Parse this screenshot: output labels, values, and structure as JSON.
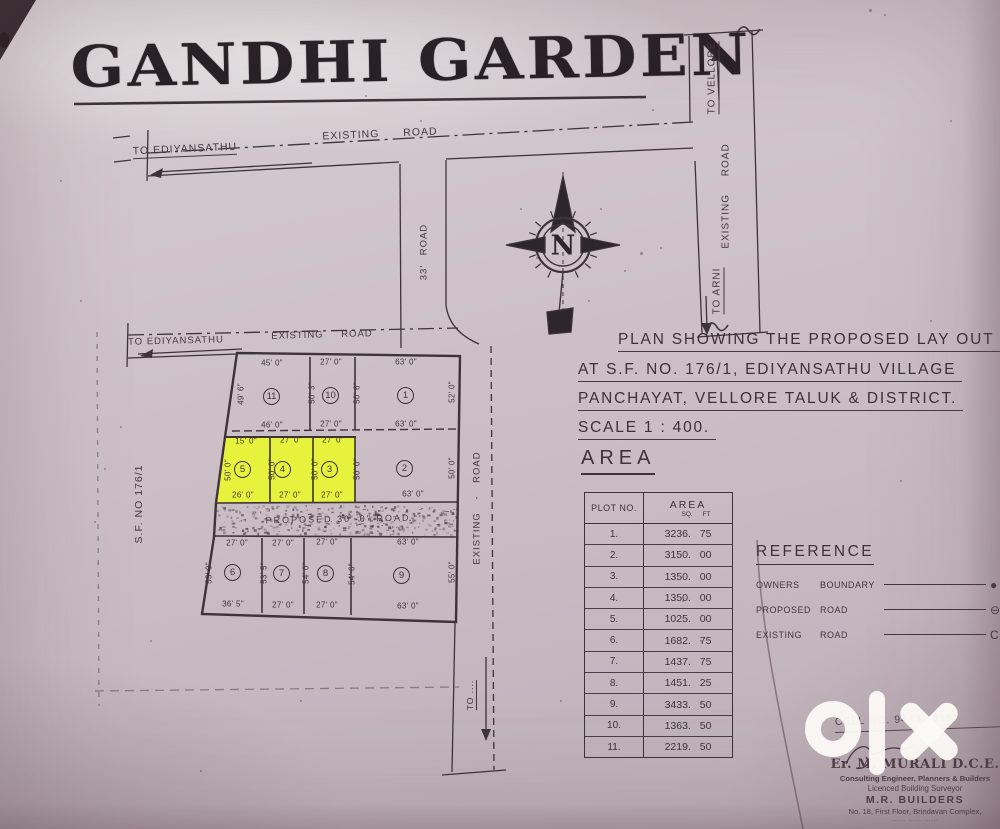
{
  "title": "GANDHI GARDEN",
  "watermark": "olx",
  "ink_color": "#3d3338",
  "highlight_color": "#e7f23d",
  "compass_label": "N",
  "top_road": {
    "destination": "TO EDIYANSATHU",
    "name": "EXISTING ROAD"
  },
  "highway": {
    "up": "TO VELLORE",
    "name": "EXISTING ROAD",
    "down": "TO ARNI"
  },
  "connector_road_label": "33' ROAD",
  "east_road": {
    "name": "EXISTING - ROAD",
    "down": "TO ...."
  },
  "layout_road": {
    "destination": "TO EDIYANSATHU",
    "name": "EXISTING ROAD"
  },
  "internal_road_label": "PROPOSED 30'-0\" ROAD",
  "survey_no_label": "S.F. NO 176/1",
  "plan_note": {
    "lines": [
      "PLAN SHOWING THE PROPOSED LAY OUT",
      "AT S.F. NO. 176/1,  EDIYANSATHU   VILLAGE",
      "PANCHAYAT,  VELLORE  TALUK  &  DISTRICT.",
      "SCALE  1 : 400."
    ]
  },
  "area_section": {
    "heading": "AREA",
    "table": {
      "col_plot": "PLOT NO.",
      "col_area": "AREA",
      "col_area_sub": "SQ. FT",
      "rows": [
        {
          "plot": "1.",
          "area": "3236. 75"
        },
        {
          "plot": "2.",
          "area": "3150. 00"
        },
        {
          "plot": "3.",
          "area": "1350. 00"
        },
        {
          "plot": "4.",
          "area": "1350. 00"
        },
        {
          "plot": "5.",
          "area": "1025. 00"
        },
        {
          "plot": "6.",
          "area": "1682. 75"
        },
        {
          "plot": "7.",
          "area": "1437. 75"
        },
        {
          "plot": "8.",
          "area": "1451. 25"
        },
        {
          "plot": "9.",
          "area": "3433. 50"
        },
        {
          "plot": "10.",
          "area": "1363. 50"
        },
        {
          "plot": "11.",
          "area": "2219. 50"
        }
      ]
    }
  },
  "reference": {
    "heading": "REFERENCE",
    "items": [
      {
        "name": "OWNERS",
        "kind": "BOUNDARY",
        "symbol": "●"
      },
      {
        "name": "PROPOSED",
        "kind": "ROAD",
        "symbol": "⊖"
      },
      {
        "name": "EXISTING",
        "kind": "ROAD",
        "symbol": "C"
      }
    ]
  },
  "plots": {
    "row1": {
      "numbers": [
        "11",
        "10",
        "1"
      ],
      "top_dims": [
        "45' 0\"",
        "27' 0\"",
        "63' 0\""
      ],
      "bottom_dims": [
        "46' 0\"",
        "27' 0\"",
        "63' 0\""
      ],
      "side_dims": [
        "49' 6\"",
        "50' 3\"",
        "50' 6\"",
        "52' 0\""
      ]
    },
    "row2": {
      "numbers": [
        "5",
        "4",
        "3",
        "2"
      ],
      "highlighted": [
        "5",
        "4",
        "3"
      ],
      "top_dims": [
        "15' 0\"",
        "27' 0\"",
        "27' 0\""
      ],
      "bottom_dims": [
        "26' 0\"",
        "27' 0\"",
        "27' 0\"",
        "63' 0\""
      ],
      "side_dims": [
        "50' 0\"",
        "50' 0\"",
        "50' 0\"",
        "50' 0\"",
        "50' 0\""
      ]
    },
    "row3": {
      "numbers": [
        "6",
        "7",
        "8",
        "9"
      ],
      "top_dims": [
        "27' 0\"",
        "27' 0\"",
        "27' 0\"",
        "63' 0\""
      ],
      "bottom_dims": [
        "36' 5\"",
        "27' 0\"",
        "27' 0\"",
        "63' 0\""
      ],
      "side_dims": [
        "53' 0\"",
        "53' 5\"",
        "54' 0\"",
        "54' 6\"",
        "55' 0\""
      ]
    }
  },
  "contact": {
    "cell": "CELL NO. 94431 815"
  },
  "stamp": {
    "name": "Er. M. MURALI D.C.E.",
    "line1": "Consulting Engineer, Planners & Builders",
    "line2": "Licenced Building Surveyor",
    "firm": "M.R. BUILDERS",
    "address": "No. 18, First Floor, Brindavan Complex,",
    "address2": "…… …… ……"
  }
}
